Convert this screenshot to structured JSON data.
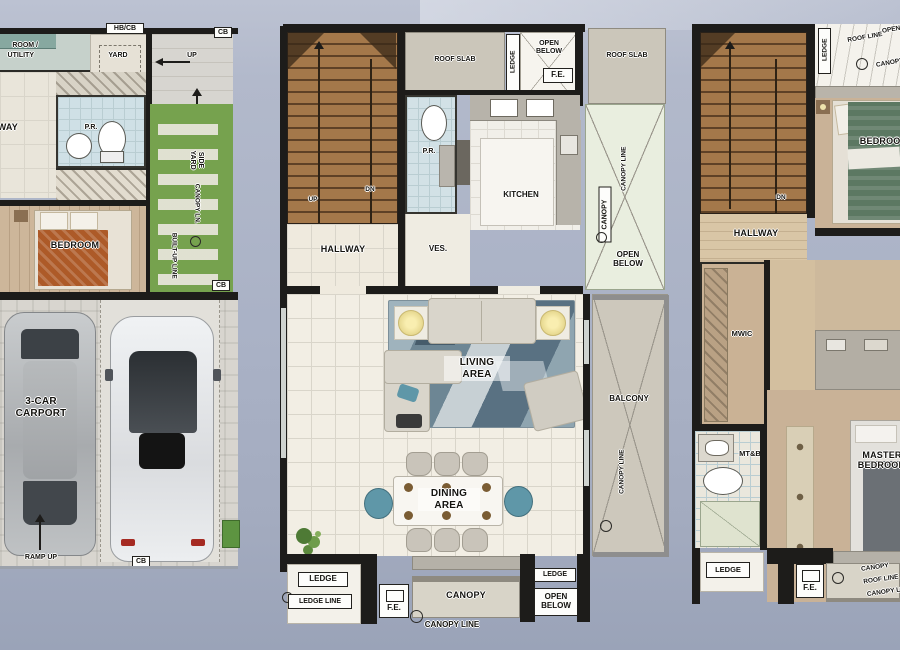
{
  "ground": {
    "maid_room_line1": "ROOM /",
    "maid_room_line2": "UTILITY",
    "hb_cb": "HB/CB",
    "yard": "YARD",
    "up_entry": "UP",
    "cb_top": "CB",
    "up_side": "UP",
    "hallway": "HALLWAY",
    "pr": "P.R.",
    "side_yard": "SIDE YARD",
    "canopy_ln": "CANOPY LN.",
    "built_up_line": "BUILT-UP LINE",
    "cb_side": "CB",
    "bedroom": "BEDROOM",
    "carport": "3-CAR CARPORT",
    "ramp_up": "RAMP UP",
    "cb_bottom": "CB"
  },
  "second": {
    "up": "UP",
    "dn": "DN",
    "roof_slab_left": "ROOF SLAB",
    "ledge_top": "LEDGE",
    "open_below_top": "OPEN BELOW",
    "fe_top": "F.E.",
    "roof_slab_right": "ROOF SLAB",
    "pr": "P.R.",
    "kitchen": "KITCHEN",
    "hallway": "HALLWAY",
    "ves": "VES.",
    "canopy_line_upper": "CANOPY LINE",
    "canopy_side": "CANOPY",
    "open_below_side": "OPEN BELOW",
    "living_area": "LIVING AREA",
    "dining_area": "DINING AREA",
    "balcony": "BALCONY",
    "canopy_line_balcony": "CANOPY LINE",
    "ledge_bottom_left": "LEDGE",
    "ledge_line": "LEDGE LINE",
    "fe_bottom": "F.E.",
    "canopy_bottom": "CANOPY",
    "canopy_line_bottom": "CANOPY LINE",
    "ledge_bottom_right": "LEDGE",
    "open_below_bottom": "OPEN BELOW"
  },
  "third": {
    "dn": "DN",
    "ledge_top": "LEDGE",
    "roof_line_top": "ROOF LINE",
    "open_below_top": "OPEN BELOW",
    "canopy_line_top": "CANOPY LINE",
    "bedroom": "BEDROOM",
    "hallway": "HALLWAY",
    "mwic": "MWIC",
    "mtb": "MT&B",
    "ledge_bottom": "LEDGE",
    "master_bedroom": "MASTER BEDROOM",
    "fe_bottom": "F.E.",
    "canopy_bottom": "CANOPY",
    "roof_line_bottom": "ROOF LINE",
    "canopy_line_bottom": "CANOPY LINE"
  },
  "colors": {
    "wall": "#1d1c1a",
    "grass": "#76a24e",
    "stair_wood": "#8a6138",
    "bedroom_wood": "#cdb69a",
    "rug_blue": "#6d8694",
    "bed_orange": "#ad5a28",
    "bed_green": "#5c7862",
    "pr_tile_blue": "#cfe0e6",
    "roof_slab": "#cbc6ba",
    "background": "#a9b1c5"
  }
}
